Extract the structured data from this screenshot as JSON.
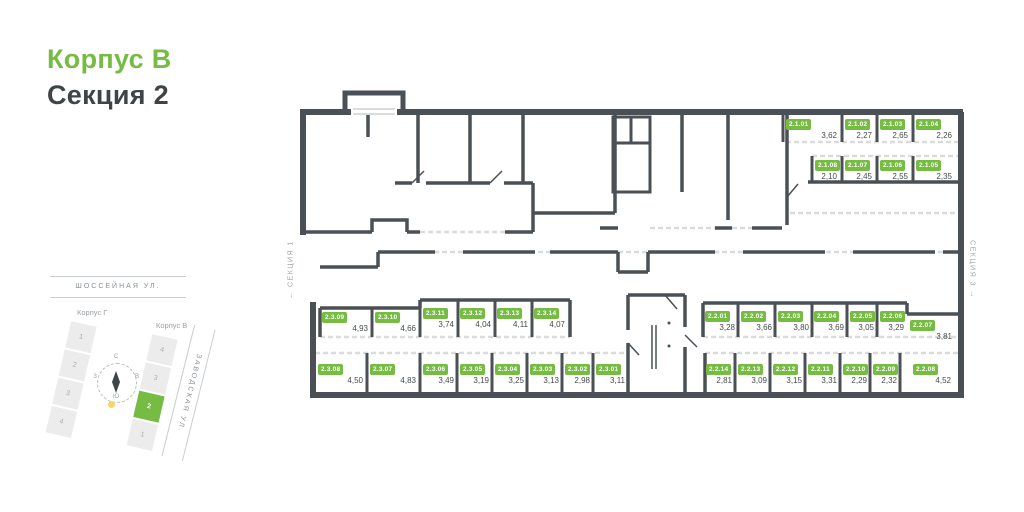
{
  "header": {
    "building": "Корпус В",
    "section": "Секция 2"
  },
  "side_labels": {
    "left": "← СЕКЦИЯ 1",
    "right": "СЕКЦИЯ 3 →"
  },
  "minimap": {
    "street_top": "ШОССЕЙНАЯ УЛ.",
    "street_right": "ЗАВОДСКАЯ УЛ.",
    "building_left": {
      "label": "Корпус Г",
      "sections": [
        "1",
        "2",
        "3",
        "4"
      ]
    },
    "building_right": {
      "label": "Корпус В",
      "sections": [
        "4",
        "3",
        "2",
        "1"
      ],
      "active_section": "2"
    },
    "compass": {
      "north": "С",
      "east": "В",
      "south": "Ю",
      "west": "З"
    }
  },
  "colors": {
    "accent_green": "#76BC43",
    "wall": "#4A5055",
    "text_dark": "#3F4547",
    "text_gray": "#9AA0A4",
    "dash_light": "#D9DBDC",
    "sun_yellow": "#F6D75E"
  },
  "units": [
    {
      "id": "2.1.01",
      "area": "3,62"
    },
    {
      "id": "2.1.02",
      "area": "2,27"
    },
    {
      "id": "2.1.03",
      "area": "2,65"
    },
    {
      "id": "2.1.04",
      "area": "2,26"
    },
    {
      "id": "2.1.08",
      "area": "2,10"
    },
    {
      "id": "2.1.07",
      "area": "2,45"
    },
    {
      "id": "2.1.06",
      "area": "2,55"
    },
    {
      "id": "2.1.05",
      "area": "2,35"
    },
    {
      "id": "2.3.09",
      "area": "4,93"
    },
    {
      "id": "2.3.10",
      "area": "4,66"
    },
    {
      "id": "2.3.11",
      "area": "3,74"
    },
    {
      "id": "2.3.12",
      "area": "4,04"
    },
    {
      "id": "2.3.13",
      "area": "4,11"
    },
    {
      "id": "2.3.14",
      "area": "4,07"
    },
    {
      "id": "2.2.01",
      "area": "3,28"
    },
    {
      "id": "2.2.02",
      "area": "3,66"
    },
    {
      "id": "2.2.03",
      "area": "3,80"
    },
    {
      "id": "2.2.04",
      "area": "3,69"
    },
    {
      "id": "2.2.05",
      "area": "3,05"
    },
    {
      "id": "2.2.06",
      "area": "3,29"
    },
    {
      "id": "2.2.07",
      "area": "3,81"
    },
    {
      "id": "2.3.08",
      "area": "4,50"
    },
    {
      "id": "2.3.07",
      "area": "4,83"
    },
    {
      "id": "2.3.06",
      "area": "3,49"
    },
    {
      "id": "2.3.05",
      "area": "3,19"
    },
    {
      "id": "2.3.04",
      "area": "3,25"
    },
    {
      "id": "2.3.03",
      "area": "3,13"
    },
    {
      "id": "2.3.02",
      "area": "2,98"
    },
    {
      "id": "2.3.01",
      "area": "3,11"
    },
    {
      "id": "2.2.14",
      "area": "2,81"
    },
    {
      "id": "2.2.13",
      "area": "3,09"
    },
    {
      "id": "2.2.12",
      "area": "3,15"
    },
    {
      "id": "2.2.11",
      "area": "3,31"
    },
    {
      "id": "2.2.10",
      "area": "2,29"
    },
    {
      "id": "2.2.09",
      "area": "2,32"
    },
    {
      "id": "2.2.08",
      "area": "4,52"
    }
  ]
}
